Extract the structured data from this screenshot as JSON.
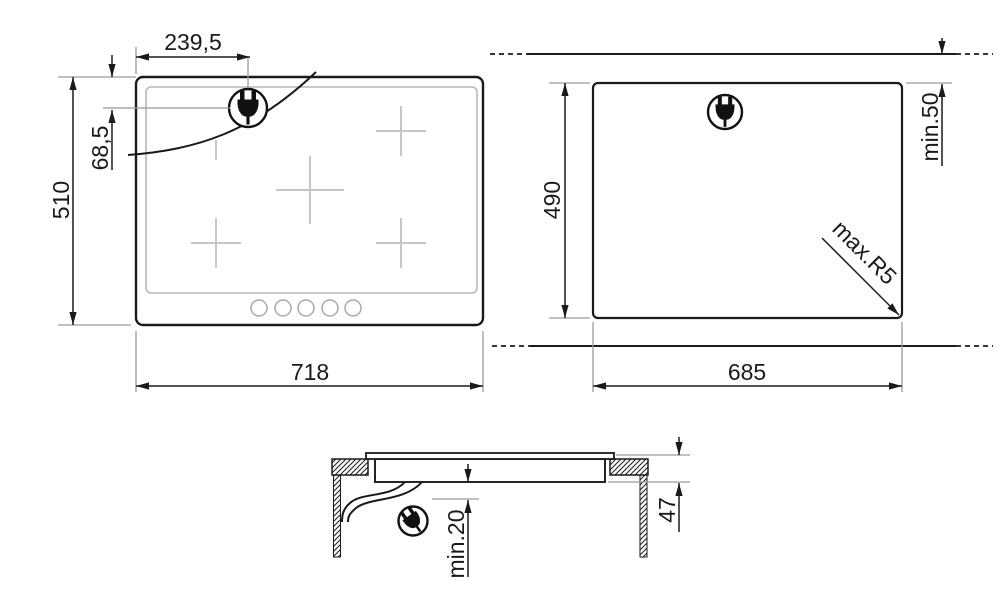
{
  "diagram": {
    "kind": "hob-installation-drawing",
    "colors": {
      "line": "#1a1a1a",
      "extension_line": "#9a9a9a",
      "glass_detail": "#c6c6c6",
      "background": "#ffffff"
    },
    "top_view": {
      "labels": {
        "plug_offset_x": "239,5",
        "plug_offset_y": "68,5",
        "height": "510",
        "width": "718"
      },
      "burner_zones": 5,
      "control_dots": 5,
      "plug_icon": "power-plug"
    },
    "cutout_view": {
      "labels": {
        "depth": "490",
        "width": "685",
        "rear_clearance": "min.50",
        "corner_radius": "max.R5"
      },
      "plug_icon": "power-plug"
    },
    "side_view": {
      "labels": {
        "bottom_clearance": "min.20",
        "overall_depth": "47"
      },
      "plug_icon": "power-plug"
    }
  }
}
